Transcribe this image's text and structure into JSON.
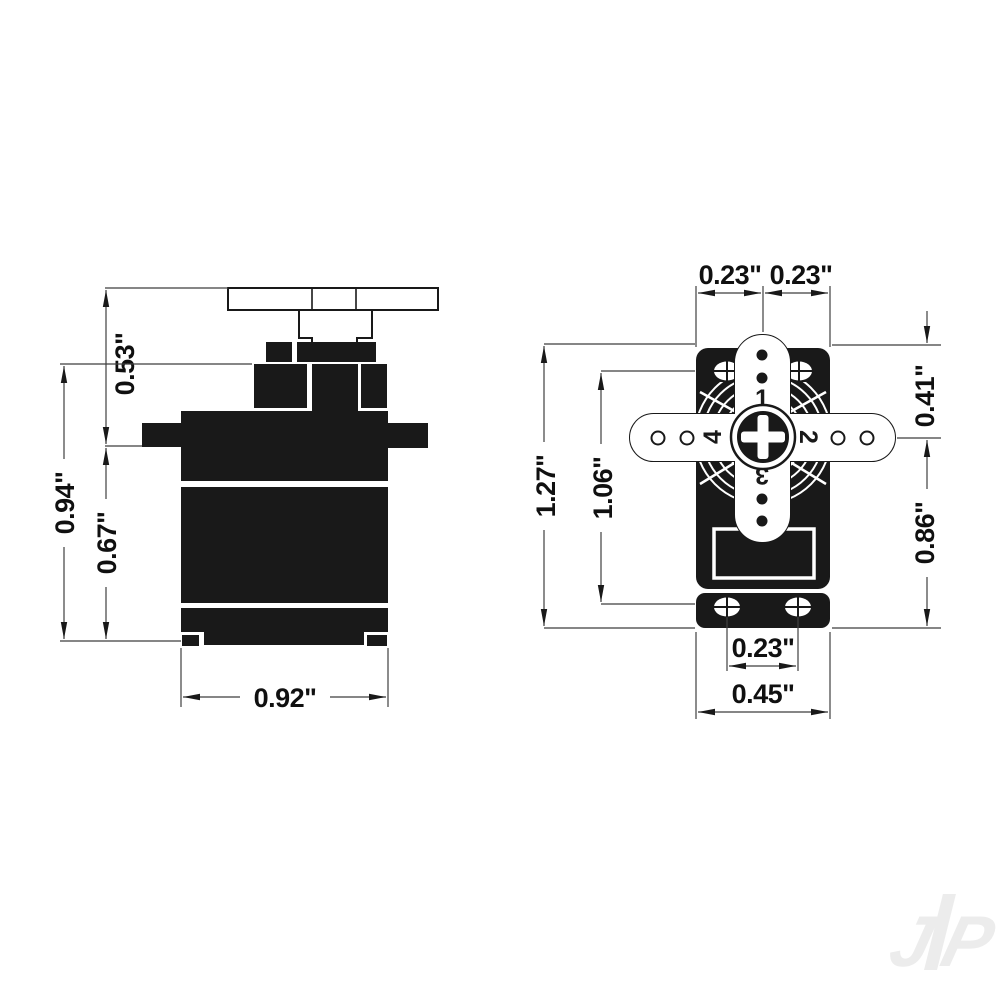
{
  "drawing": {
    "type": "technical-dimension-drawing",
    "subject": "micro servo two-view dimensional diagram",
    "units": "inches",
    "colors": {
      "ink": "#191919",
      "dimension_line": "#3f3f3f",
      "background": "#ffffff",
      "watermark": "#ececec"
    },
    "side_view": {
      "dims": {
        "horn_to_flange": "0.53\"",
        "flange_to_bottom": "0.94\"",
        "body_height": "0.67\"",
        "body_width": "0.92\""
      }
    },
    "top_view": {
      "dims": {
        "axis_to_left_edge": "0.23\"",
        "axis_to_right_edge": "0.23\"",
        "overall_length": "1.27\"",
        "mount_hole_spacing": "1.06\"",
        "top_edge_to_axis": "0.41\"",
        "axis_to_bottom_edge": "0.86\"",
        "bottom_hole_spacing": "0.23\"",
        "case_width": "0.45\""
      },
      "horn_arm_numbers": [
        "1",
        "2",
        "3",
        "4"
      ]
    },
    "watermark": {
      "letter_j": "J",
      "letter_p": "P"
    }
  }
}
